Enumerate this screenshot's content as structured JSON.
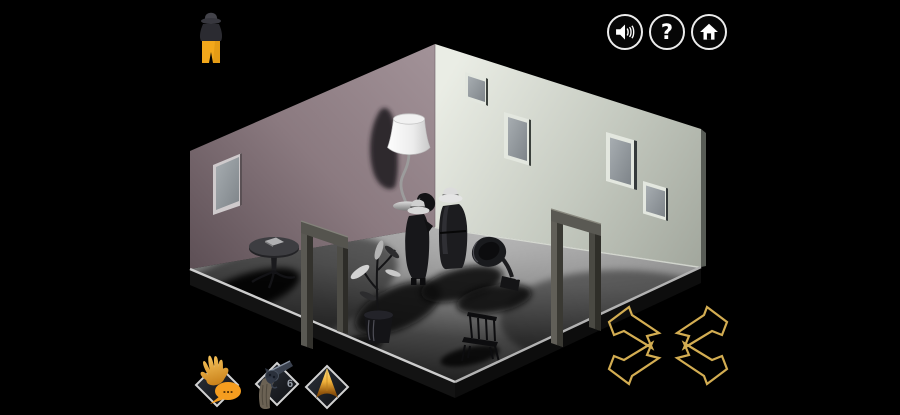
{
  "hud": {
    "player_indicator": {
      "icon": "detective-figure-icon"
    },
    "topbar_buttons": [
      {
        "id": "sound",
        "icon": "speaker-icon"
      },
      {
        "id": "help",
        "icon": "question-mark-icon",
        "glyph": "?"
      },
      {
        "id": "home",
        "icon": "home-icon"
      }
    ],
    "action_buttons": [
      {
        "id": "talk",
        "icon": "hand-speech-bubble-icon",
        "bubble_text": "..."
      },
      {
        "id": "weapon",
        "icon": "revolver-icon",
        "ammo": "6"
      },
      {
        "id": "compass",
        "icon": "gold-peak-icon"
      }
    ],
    "nav_arrows": [
      {
        "id": "up-left"
      },
      {
        "id": "up-right"
      },
      {
        "id": "down-left"
      },
      {
        "id": "down-right"
      }
    ]
  },
  "scene": {
    "room": {
      "left_wall_color": "#8b7a80",
      "right_wall_color": "#d5dad1",
      "floor_near_color": "#a3a3a3",
      "floor_far_color": "#141414",
      "windows_left_wall": 1,
      "windows_right_wall": 4,
      "doorways": 2
    },
    "objects": [
      "floor-lamp",
      "round-pedestal-table",
      "book",
      "potted-plant",
      "gramophone",
      "chair",
      "detective-standing-left",
      "detective-standing-right"
    ]
  },
  "colors": {
    "background": "#000000",
    "accent_gold": "#d3ad52",
    "bubble_orange": "#f59d1f",
    "pants_yellow": "#f3a81b",
    "ui_border_white": "#ececec"
  }
}
